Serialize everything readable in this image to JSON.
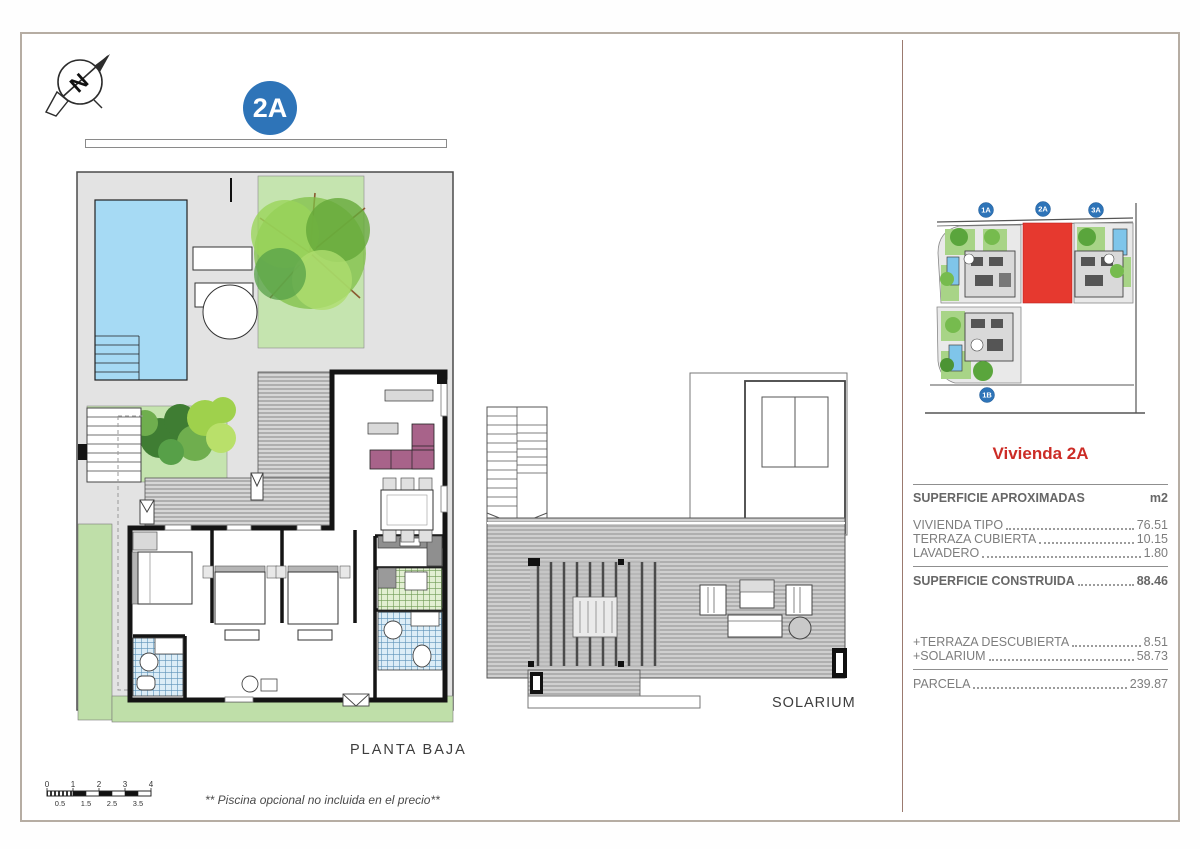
{
  "header": {
    "badge": "2A"
  },
  "compass": {
    "letter": "N"
  },
  "floor_plan": {
    "label": "PLANTA BAJA"
  },
  "solarium": {
    "label": "SOLARIUM"
  },
  "site_plan": {
    "badges": [
      {
        "id": "1A"
      },
      {
        "id": "2A"
      },
      {
        "id": "3A"
      },
      {
        "id": "1B"
      }
    ],
    "highlighted_unit": "2A"
  },
  "panel": {
    "title": "Vivienda 2A",
    "table": {
      "header": {
        "label": "SUPERFICIE APROXIMADAS",
        "unit": "m2"
      },
      "rows": [
        {
          "label": "VIVIENDA TIPO",
          "value": "76.51"
        },
        {
          "label": "TERRAZA CUBIERTA",
          "value": "10.15"
        },
        {
          "label": "LAVADERO",
          "value": "1.80"
        }
      ],
      "subtotal": {
        "label": "SUPERFICIE CONSTRUIDA",
        "value": "88.46"
      },
      "extras": [
        {
          "label": "+TERRAZA DESCUBIERTA",
          "value": "8.51"
        },
        {
          "label": "+SOLARIUM",
          "value": "58.73"
        }
      ],
      "total": {
        "label": "PARCELA",
        "value": "239.87"
      }
    }
  },
  "footer": {
    "scale_top": [
      "0",
      "1",
      "2",
      "3",
      "4"
    ],
    "scale_bottom": [
      "0.5",
      "1.5",
      "2.5",
      "3.5"
    ],
    "disclaimer": "** Piscina opcional no incluida en el precio**"
  },
  "colors": {
    "badge_blue": "#2e74b8",
    "highlight_red": "#e6392f",
    "title_red": "#cc2c26",
    "pool_blue": "#a6daf4",
    "garden_green": "#c5e4af",
    "sofa_mauve": "#a8638a",
    "bath_tile_blue": "#5d93b8",
    "laundry_tile_green": "#6f9b55",
    "wall_black": "#141414",
    "frame_gray": "#b6ada3",
    "divider_brown": "#9b7a6f"
  }
}
